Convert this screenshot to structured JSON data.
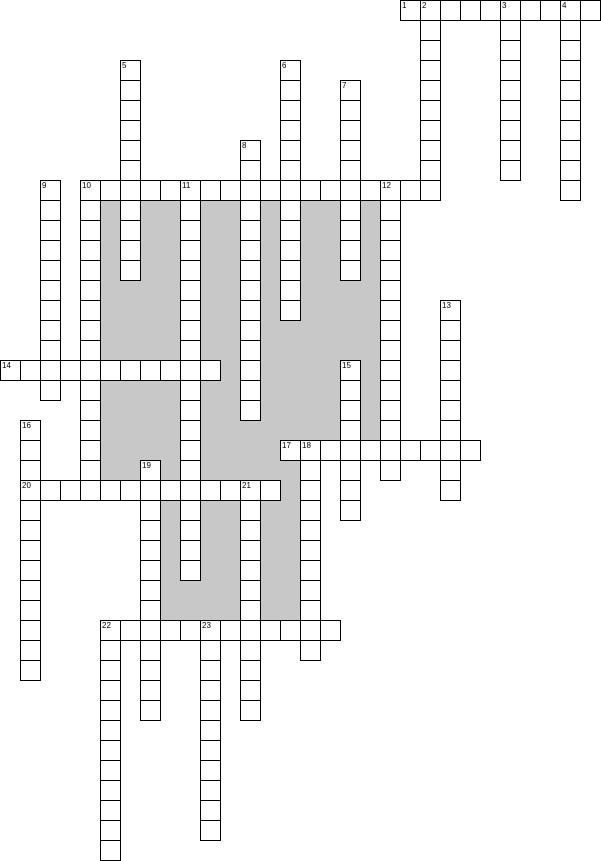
{
  "page": {
    "background": "#ffffff",
    "description": "Empty numbered crossword puzzle grid with gray shaded filler regions"
  },
  "crossword": {
    "cell_size": 20,
    "canvas": {
      "width": 601,
      "height": 861
    },
    "colors": {
      "line": "#000000",
      "cell_fill": "#ffffff",
      "shade_fill": "#c8c8c8",
      "number_text": "#000000"
    },
    "shaded_regions": [
      {
        "x": 100,
        "y": 200,
        "w": 280,
        "h": 120
      },
      {
        "x": 100,
        "y": 320,
        "w": 200,
        "h": 160
      },
      {
        "x": 300,
        "y": 320,
        "w": 80,
        "h": 120
      },
      {
        "x": 160,
        "y": 500,
        "w": 140,
        "h": 120
      },
      {
        "x": 280,
        "y": 460,
        "w": 20,
        "h": 160
      }
    ],
    "across_words": [
      {
        "number": "1",
        "col": 20,
        "row": 0,
        "length": 10
      },
      {
        "number": "10",
        "col": 4,
        "row": 9,
        "length": 18
      },
      {
        "number": "14",
        "col": 0,
        "row": 18,
        "length": 11
      },
      {
        "number": "17",
        "col": 14,
        "row": 22,
        "length": 10
      },
      {
        "number": "20",
        "col": 1,
        "row": 24,
        "length": 13
      },
      {
        "number": "22",
        "col": 5,
        "row": 31,
        "length": 12
      }
    ],
    "down_words": [
      {
        "number": "2",
        "col": 21,
        "row": 0,
        "length": 10
      },
      {
        "number": "3",
        "col": 25,
        "row": 0,
        "length": 9
      },
      {
        "number": "4",
        "col": 28,
        "row": 0,
        "length": 10
      },
      {
        "number": "5",
        "col": 6,
        "row": 3,
        "length": 11
      },
      {
        "number": "6",
        "col": 14,
        "row": 3,
        "length": 13
      },
      {
        "number": "7",
        "col": 17,
        "row": 4,
        "length": 10
      },
      {
        "number": "8",
        "col": 12,
        "row": 7,
        "length": 14
      },
      {
        "number": "9",
        "col": 2,
        "row": 9,
        "length": 11
      },
      {
        "number": "10",
        "col": 4,
        "row": 9,
        "length": 16
      },
      {
        "number": "11",
        "col": 9,
        "row": 9,
        "length": 20
      },
      {
        "number": "12",
        "col": 19,
        "row": 9,
        "length": 15
      },
      {
        "number": "13",
        "col": 22,
        "row": 15,
        "length": 10
      },
      {
        "number": "15",
        "col": 17,
        "row": 18,
        "length": 8
      },
      {
        "number": "16",
        "col": 1,
        "row": 21,
        "length": 13
      },
      {
        "number": "18",
        "col": 15,
        "row": 22,
        "length": 11
      },
      {
        "number": "19",
        "col": 7,
        "row": 23,
        "length": 13
      },
      {
        "number": "21",
        "col": 12,
        "row": 24,
        "length": 12
      },
      {
        "number": "22",
        "col": 5,
        "row": 31,
        "length": 12
      },
      {
        "number": "23",
        "col": 10,
        "row": 31,
        "length": 11
      }
    ],
    "cell_numbers": [
      {
        "label": "1",
        "col": 20,
        "row": 0
      },
      {
        "label": "2",
        "col": 21,
        "row": 0
      },
      {
        "label": "3",
        "col": 25,
        "row": 0
      },
      {
        "label": "4",
        "col": 28,
        "row": 0
      },
      {
        "label": "5",
        "col": 6,
        "row": 3
      },
      {
        "label": "6",
        "col": 14,
        "row": 3
      },
      {
        "label": "7",
        "col": 17,
        "row": 4
      },
      {
        "label": "8",
        "col": 12,
        "row": 7
      },
      {
        "label": "9",
        "col": 2,
        "row": 9
      },
      {
        "label": "10",
        "col": 4,
        "row": 9
      },
      {
        "label": "11",
        "col": 9,
        "row": 9
      },
      {
        "label": "12",
        "col": 19,
        "row": 9
      },
      {
        "label": "13",
        "col": 22,
        "row": 15
      },
      {
        "label": "14",
        "col": 0,
        "row": 18
      },
      {
        "label": "15",
        "col": 17,
        "row": 18
      },
      {
        "label": "16",
        "col": 1,
        "row": 21
      },
      {
        "label": "17",
        "col": 14,
        "row": 22
      },
      {
        "label": "18",
        "col": 15,
        "row": 22
      },
      {
        "label": "19",
        "col": 7,
        "row": 23
      },
      {
        "label": "20",
        "col": 1,
        "row": 24
      },
      {
        "label": "21",
        "col": 12,
        "row": 24
      },
      {
        "label": "22",
        "col": 5,
        "row": 31
      },
      {
        "label": "23",
        "col": 10,
        "row": 31
      }
    ]
  }
}
